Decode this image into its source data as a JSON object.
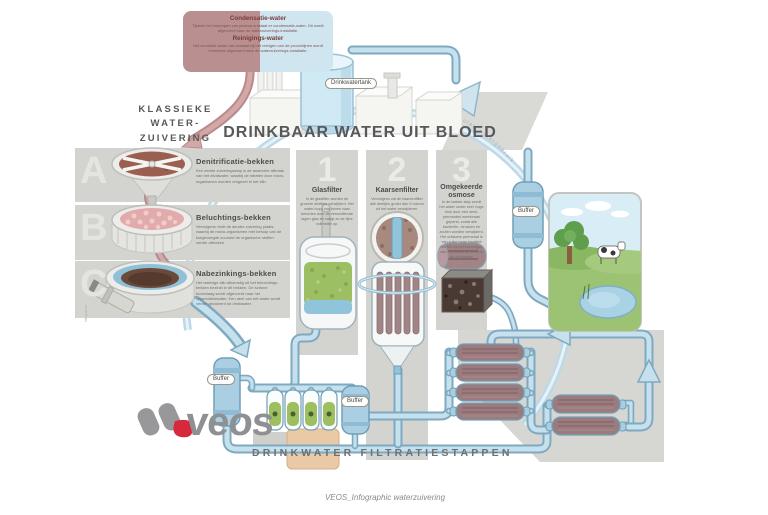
{
  "header": {
    "title": "DRINKBAAR WATER UIT BLOED",
    "left_heading_lines": [
      "KLASSIEKE",
      "WATER-",
      "ZUIVERING"
    ],
    "info_box": {
      "condensatie_title": "Condensatie-water",
      "condensatie_text": "Tijdens het indampen van plasma ontstaat er condensatie-water. Dit wordt afgevoerd naar de waterzuiverings-installatie.",
      "reinigings_title": "Reinigings-water",
      "reinigings_text": "Het vervuilde water dat ontstaat bij het reinigen van de proceslijnen wordt eveneens afgevoerd naar de waterzuiverings-installatie."
    }
  },
  "classic_steps": [
    {
      "letter": "A",
      "title": "Denitrificatie-bekken",
      "text": "Een eerste zuiveringsstap is de anaerobe afbraak van het afvalwater, waarbij de nitraten door micro-organismen worden omgezet in het slib."
    },
    {
      "letter": "B",
      "title": "Beluchtings-bekken",
      "text": "Vervolgens vindt de aerobe zuivering plaats, waarbij de micro-organismen met behulp van de toegevoegde zuurstof de organische stoffen verder afbreken."
    },
    {
      "letter": "C",
      "title": "Nabezinkings-bekken",
      "text": "Het waterige slib afkomstig uit het beluchtings-bekken bezinkt in dit bekken. De schone bovenlaag wordt afgevoerd naar het oppervlaktewater. Een deel van het water wordt verder gezuiverd tot drinkwater."
    }
  ],
  "filter_steps": [
    {
      "number": "1",
      "title": "Glasfilter",
      "text": "In de glasfilter worden de grovere deeltjes verwijderd. Het water loopt van boven naar beneden door de verschillende lagen glas en vangt zo de fijne vuilresten op."
    },
    {
      "number": "2",
      "title": "Kaarsenfilter",
      "text": "Vervolgens zal de kaarsenfilter alle deeltjes groter dan 5 micron uit het water verwijderen."
    },
    {
      "number": "3",
      "title": "Omgekeerde osmose",
      "text": "In de laatste stap wordt het water onder zeer hoge druk door een semi-permeabel membraan geperst, zodat alle bacteriën, virussen en zouten worden verwijderd. Het ontstane permeaat is van zulke hoge kwaliteit dat het na het toevoegen van mineralen geschikt is als drinkwater."
    }
  ],
  "labels": {
    "drinkwatertank": "Drinkwatertank",
    "buffer1": "Buffer",
    "buffer2": "Buffer",
    "buffer3": "Buffer",
    "circular": "Circulair watergebruik",
    "bottom_heading": "DRINKWATER FILTRATIESTAPPEN",
    "credit": "Infographic"
  },
  "logo": {
    "wordmark": "veos"
  },
  "footer": {
    "caption": "VEOS_Infographic waterzuivering"
  },
  "colors": {
    "pipe_outline": "#7fa9c0",
    "pipe_fill": "#c6e1ee",
    "blood": "#b98a8a",
    "panel_gray": "#d3d3d0",
    "accent_red": "#d6293e",
    "green_media": "#9cbf63",
    "membrane_brown": "#9b7b7e",
    "sky": "#d8edf6",
    "grass": "#9cc374"
  }
}
